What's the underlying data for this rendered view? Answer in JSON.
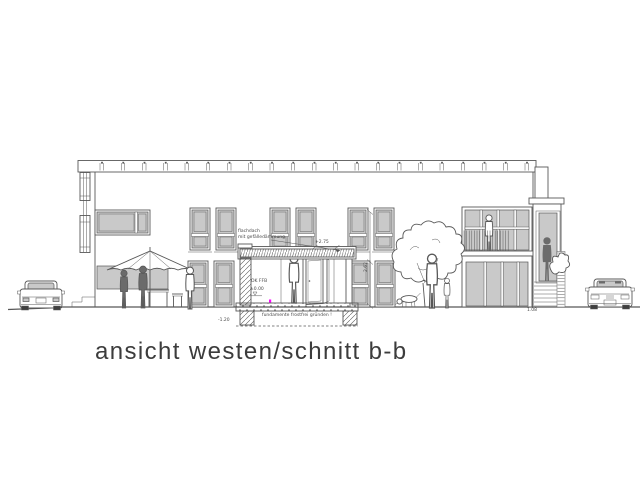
{
  "drawing": {
    "title": "ansicht westen/schnitt b-b",
    "annotations": {
      "roof_note_line1": "flachdach",
      "roof_note_line2": "mit gefälledämmung",
      "level_porch_roof": "+2.75",
      "dim_height": "2.62",
      "interior_label": "OK FFB",
      "level_floor": "±0.00",
      "foundation_note": "fundamente frostfrei gründen !",
      "level_foundation": "-1.20",
      "dim_stair": "1.08"
    },
    "colors": {
      "line": "#585858",
      "glazing": "#c9c9c9",
      "silhouette": "#6b6b6b",
      "wheel": "#3f3f3f",
      "marker": "#ff00ff",
      "title": "#3c3c3c"
    }
  }
}
